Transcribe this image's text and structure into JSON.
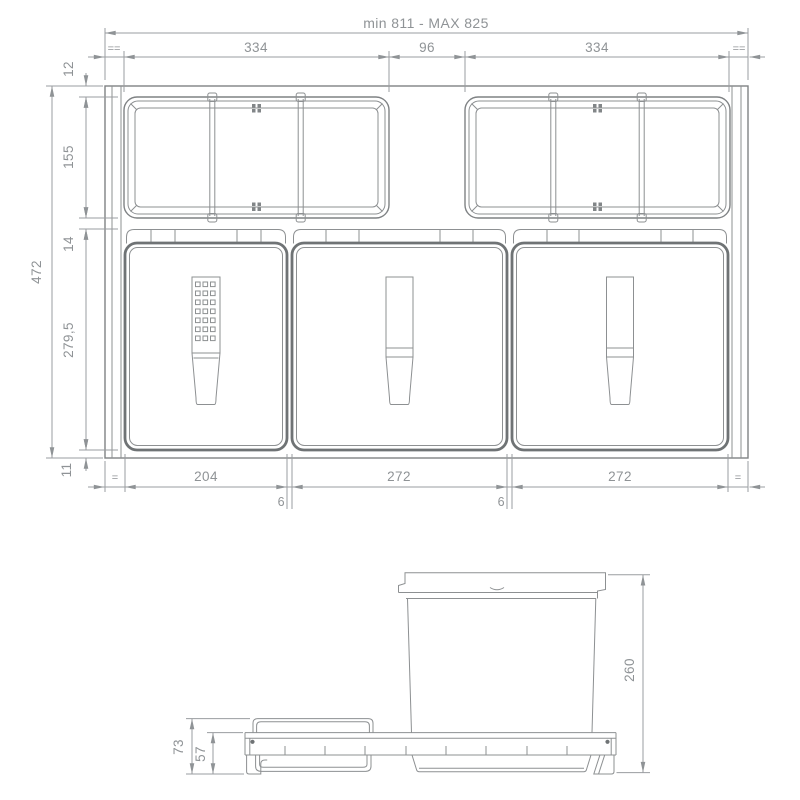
{
  "top_view": {
    "width_overall": "min 811 - MAX 825",
    "width_tray_left": "334",
    "width_center_gap": "96",
    "width_tray_right": "334",
    "equal_margin_top_left": "==",
    "equal_margin_top_right": "==",
    "height_overall": "472",
    "height_top_rim": "12",
    "height_tray": "155",
    "height_mid_gap": "14",
    "height_bin": "279,5",
    "height_bottom_rim": "11",
    "equal_margin_bottom_left": "=",
    "width_bin_small": "204",
    "gap_bin_left": "6",
    "width_bin_middle": "272",
    "gap_bin_right": "6",
    "width_bin_right": "272",
    "equal_margin_bottom_right": "="
  },
  "side_view": {
    "height_bin": "260",
    "height_tray_total": "73",
    "height_rail": "57"
  },
  "colors": {
    "thin_line": "#8d9092",
    "medium_line": "#7f8284",
    "thick_line": "#6f7375",
    "dimension_line": "#9a9da0",
    "text": "#8f9396",
    "background": "#ffffff"
  }
}
